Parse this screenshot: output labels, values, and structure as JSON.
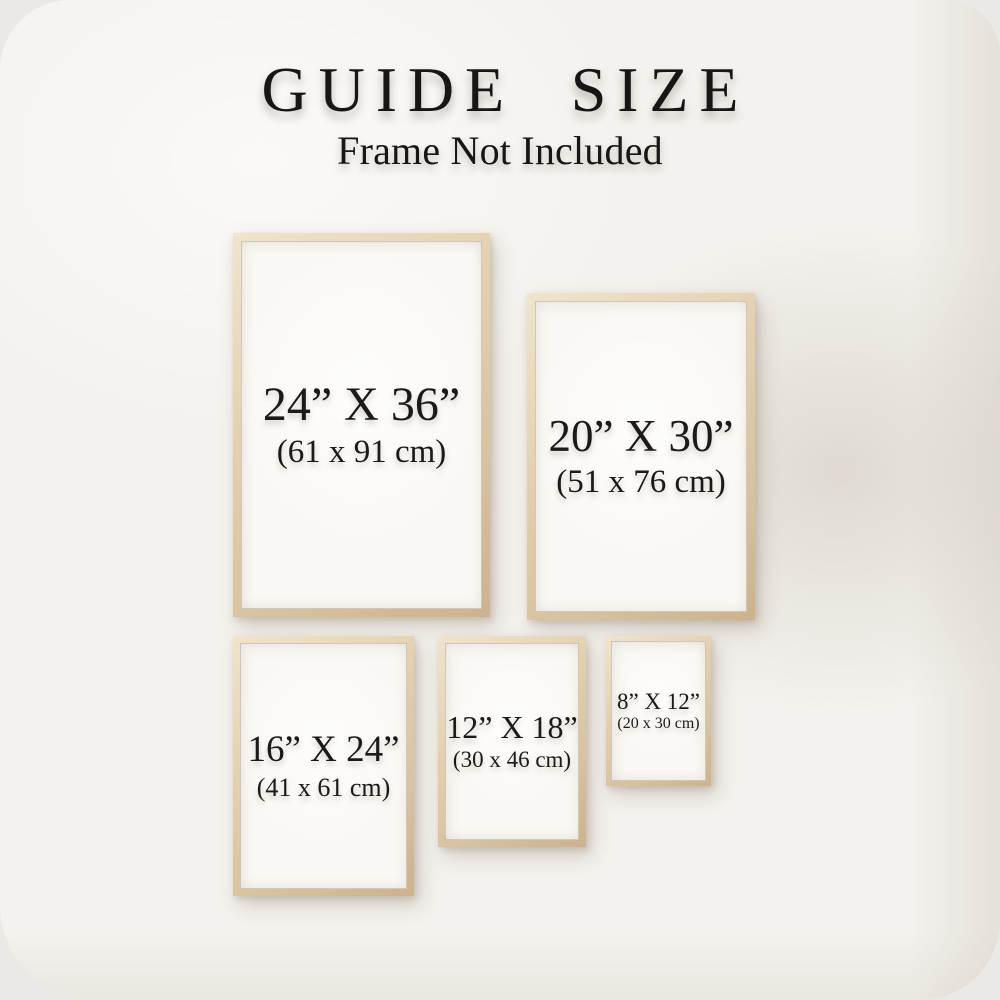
{
  "header": {
    "title": "GUIDE SIZE",
    "subtitle": "Frame Not Included"
  },
  "frames": [
    {
      "name": "24x36",
      "inches": "24” X 36”",
      "cm": "(61 x 91 cm)"
    },
    {
      "name": "20x30",
      "inches": "20” X 30”",
      "cm": "(51 x 76 cm)"
    },
    {
      "name": "16x24",
      "inches": "16” X 24”",
      "cm": "(41 x 61 cm)"
    },
    {
      "name": "12x18",
      "inches": "12” X 18”",
      "cm": "(30 x 46 cm)"
    },
    {
      "name": "8x12",
      "inches": "8” X 12”",
      "cm": "(20 x 30 cm)"
    }
  ],
  "colors": {
    "background": "#f4f2ee",
    "frame_wood": "#dcc6a6",
    "paper": "#faf8f4",
    "text": "#1b1a18"
  }
}
